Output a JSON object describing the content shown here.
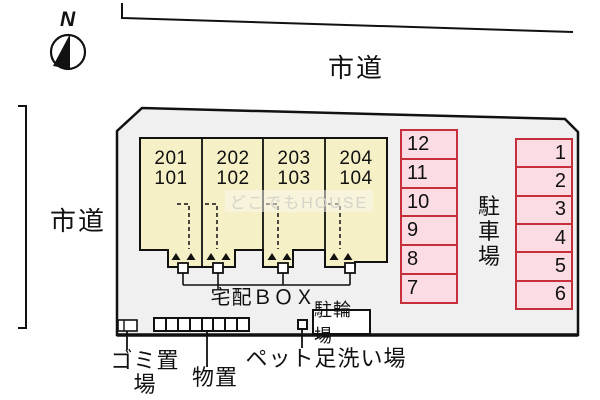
{
  "north_label": "N",
  "roads": {
    "top_label": "市道",
    "left_label": "市道"
  },
  "building": {
    "units": [
      {
        "label": "201\n101"
      },
      {
        "label": "202\n102"
      },
      {
        "label": "203\n103"
      },
      {
        "label": "204\n104"
      }
    ]
  },
  "parking": {
    "area_label": "駐車場",
    "left_column": [
      "12",
      "11",
      "10",
      "9",
      "8",
      "7"
    ],
    "right_column": [
      "1",
      "2",
      "3",
      "4",
      "5",
      "6"
    ]
  },
  "facilities": {
    "delivery_box_label": "宅配ＢＯＸ",
    "bicycle_parking_label": "駐輪場",
    "garbage_label": "ゴミ置場",
    "storage_label": "物置",
    "pet_wash_label": "ペット足洗い場"
  },
  "watermark": "どこでもHOUSE",
  "colors": {
    "building_fill": "#f6f0c6",
    "parking_fill": "#fbdce3",
    "parking_border": "#c5303c",
    "site_fill": "#f0f0f0",
    "line_color": "#111111"
  }
}
